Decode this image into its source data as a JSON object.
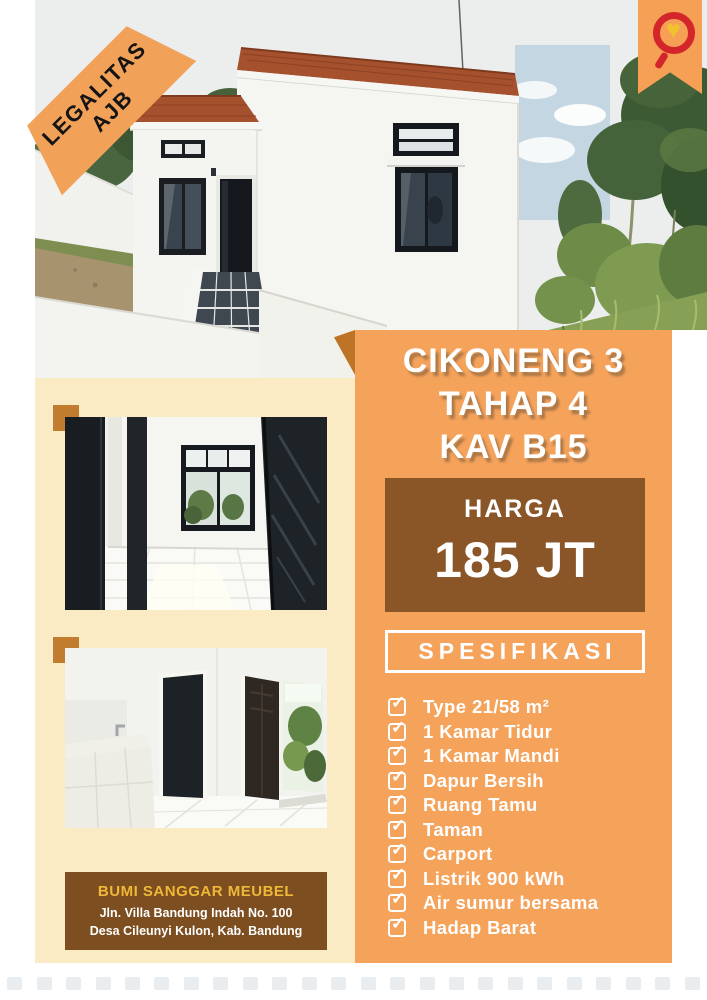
{
  "ribbon": {
    "line1": "LEGALITAS",
    "line2": "AJB"
  },
  "icons": {
    "logo_heart": "♥"
  },
  "title": {
    "line1": "CIKONENG 3",
    "line2": "TAHAP 4",
    "line3": "KAV B15"
  },
  "price": {
    "label": "HARGA",
    "value": "185 JT"
  },
  "spec": {
    "heading": "SPESIFIKASI",
    "items": [
      "Type 21/58 m²",
      "1 Kamar Tidur",
      "1 Kamar Mandi",
      "Dapur Bersih",
      "Ruang Tamu",
      "Taman",
      "Carport",
      "Listrik 900 kWh",
      "Air sumur bersama",
      "Hadap Barat"
    ]
  },
  "contact": {
    "name": "BUMI SANGGAR MEUBEL",
    "address1": "Jln. Villa Bandung Indah No. 100",
    "address2": "Desa Cileunyi Kulon, Kab. Bandung"
  },
  "colors": {
    "orange": "#F5A25B",
    "dark_orange": "#BE7427",
    "cream": "#FAEBC5",
    "price_brown": "#8A5527",
    "contact_brown": "#7C4E20",
    "gold": "#EFB838",
    "logo_red": "#D4252A",
    "logo_yellow": "#F2C22E"
  }
}
